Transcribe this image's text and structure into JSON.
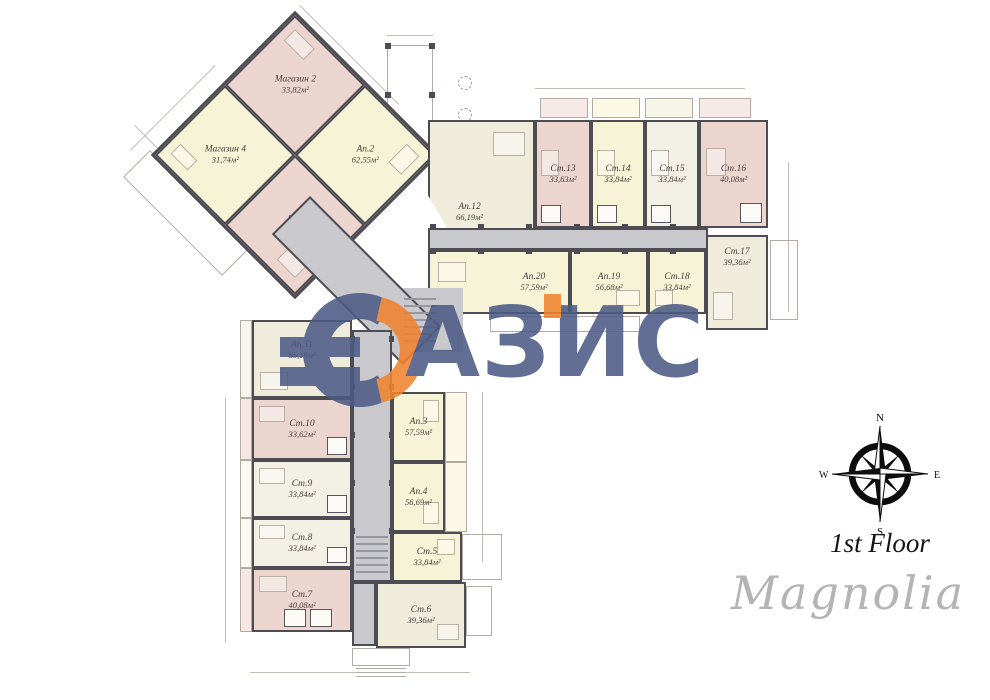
{
  "title": {
    "floor": "1st Floor",
    "project": "Magnolia"
  },
  "watermark": {
    "brand": "ОАЗИС",
    "letters": "АЗИС",
    "blue": "#4d5b86",
    "orange": "#f0832e"
  },
  "compass": {
    "north": "N",
    "east": "E",
    "south": "S",
    "west": "W"
  },
  "colors": {
    "room_pink": "#ecd5cf",
    "room_yellow": "#f7f3d6",
    "room_cream": "#efecdc",
    "corridor_gray": "#c9c8cc",
    "wall_dark": "#4c4c52"
  },
  "rooms": {
    "shop2": {
      "name": "Магазин 2",
      "area": "33,82м²"
    },
    "shop4": {
      "name": "Магазин 4",
      "area": "31,74м²"
    },
    "ap1": {
      "name": "Ап.1",
      "area": "62,55м²"
    },
    "ap2": {
      "name": "Ап.2",
      "area": "62,55м²"
    },
    "ap12": {
      "name": "Ап.12",
      "area": "66,19м²"
    },
    "st13": {
      "name": "Ст.13",
      "area": "33,63м²"
    },
    "st14": {
      "name": "Ст.14",
      "area": "33,84м²"
    },
    "st15": {
      "name": "Ст.15",
      "area": "33,84м²"
    },
    "st16": {
      "name": "Ст.16",
      "area": "40,08м²"
    },
    "st17": {
      "name": "Ст.17",
      "area": "39,36м²"
    },
    "st18": {
      "name": "Ст.18",
      "area": "33,84м²"
    },
    "ap19": {
      "name": "Ап.19",
      "area": "56,68м²"
    },
    "ap20": {
      "name": "Ап.20",
      "area": "57,59м²"
    },
    "ap11": {
      "name": "Ап.11",
      "area": "66,19м²"
    },
    "st10": {
      "name": "Ст.10",
      "area": "33,62м²"
    },
    "st9": {
      "name": "Ст.9",
      "area": "33,84м²"
    },
    "st8": {
      "name": "Ст.8",
      "area": "33,84м²"
    },
    "st7": {
      "name": "Ст.7",
      "area": "40,08м²"
    },
    "ap3": {
      "name": "Ап.3",
      "area": "57,59м²"
    },
    "ap4": {
      "name": "Ап.4",
      "area": "56,69м²"
    },
    "st5": {
      "name": "Ст.5",
      "area": "33,84м²"
    },
    "st6": {
      "name": "Ст.6",
      "area": "39,36м²"
    }
  }
}
